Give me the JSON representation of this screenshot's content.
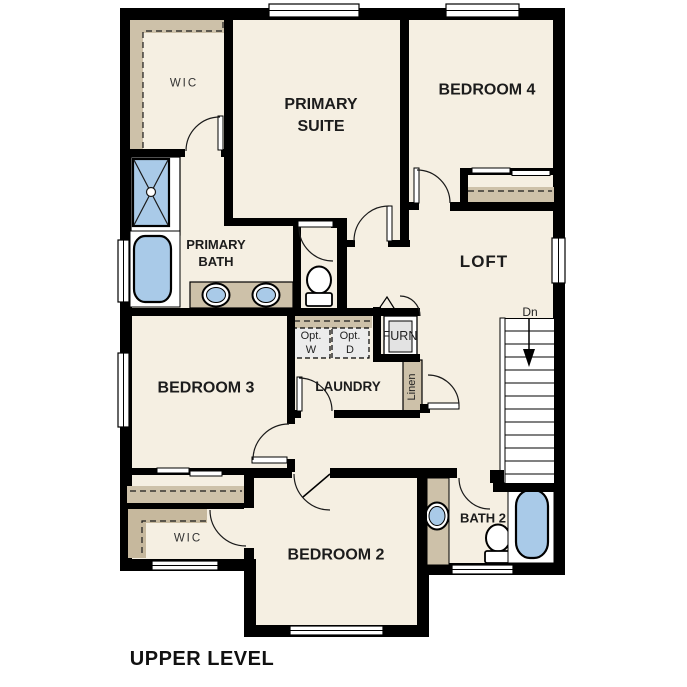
{
  "plan_title": {
    "label": "UPPER LEVEL"
  },
  "rooms": {
    "primary_suite": {
      "line1": "PRIMARY",
      "line2": "SUITE"
    },
    "bedroom_4": {
      "label": "BEDROOM 4"
    },
    "primary_bath": {
      "line1": "PRIMARY",
      "line2": "BATH"
    },
    "loft": {
      "label": "LOFT"
    },
    "bedroom_3": {
      "label": "BEDROOM 3"
    },
    "laundry": {
      "label": "LAUNDRY"
    },
    "bedroom_2": {
      "label": "BEDROOM 2"
    },
    "bath_2": {
      "label": "BATH 2"
    }
  },
  "closets": {
    "primary_wic": {
      "label": "WIC"
    },
    "bedroom2_wic": {
      "label": "WIC"
    },
    "linen": {
      "label": "Linen"
    }
  },
  "laundry_options": {
    "washer": {
      "line1": "Opt.",
      "line2": "W"
    },
    "dryer": {
      "line1": "Opt.",
      "line2": "D"
    }
  },
  "furnace": {
    "label": "FURN"
  },
  "stairs": {
    "direction_label": "Dn"
  },
  "fixture_names": [
    "shower",
    "bathtub",
    "double-sink-vanity",
    "toilet",
    "single-sink-vanity",
    "stairs-down"
  ],
  "colors": {
    "wall": "#000000",
    "floor": "#f5efe2",
    "casework_tan": "#cdc1a9",
    "wic_shelf_tan": "#c6b89d",
    "fixture_blue": "#a9cae8",
    "appliance_gray": "#ececec",
    "background": "#ffffff"
  }
}
